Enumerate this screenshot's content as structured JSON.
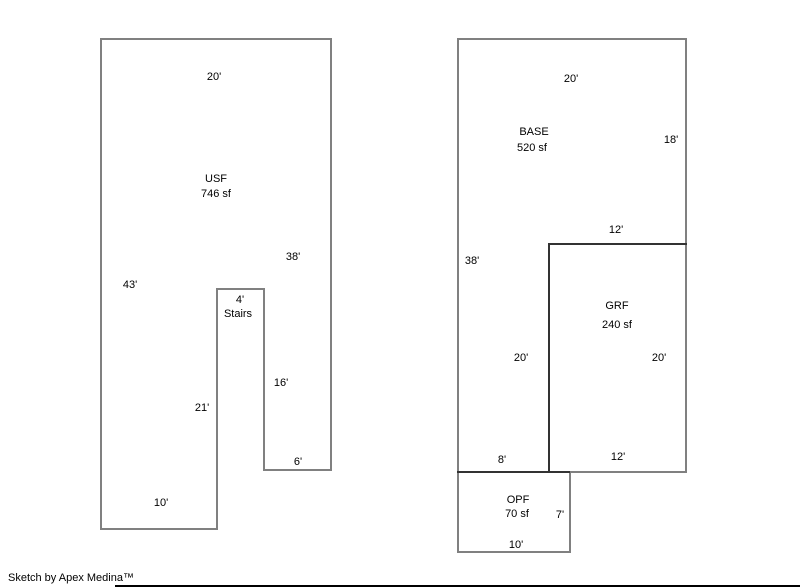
{
  "colors": {
    "outline_gray": "#808080",
    "wall_dark": "#333333",
    "text": "#000000",
    "background": "#ffffff",
    "footer_line": "#000000"
  },
  "usf": {
    "name": "USF",
    "area": "746 sf",
    "dims": {
      "top_width": "20'",
      "right_height": "38'",
      "left_height": "43'",
      "stairs_width": "4'",
      "stairs_label": "Stairs",
      "leg_inner_height": "16'",
      "notch_height": "21'",
      "leg_bottom_width": "6'",
      "bottom_width": "10'"
    }
  },
  "base": {
    "name": "BASE",
    "area": "520 sf",
    "dims": {
      "top_width": "20'",
      "right_upper_height": "18'",
      "left_height": "38'",
      "inner_height": "20'",
      "bottom_width": "8'"
    }
  },
  "grf": {
    "name": "GRF",
    "area": "240 sf",
    "dims": {
      "top_width": "12'",
      "right_height": "20'",
      "bottom_width": "12'"
    }
  },
  "opf": {
    "name": "OPF",
    "area": "70 sf",
    "dims": {
      "right_height": "7'",
      "bottom_width": "10'"
    }
  },
  "footer": {
    "credit": "Sketch by Apex Medina™"
  }
}
